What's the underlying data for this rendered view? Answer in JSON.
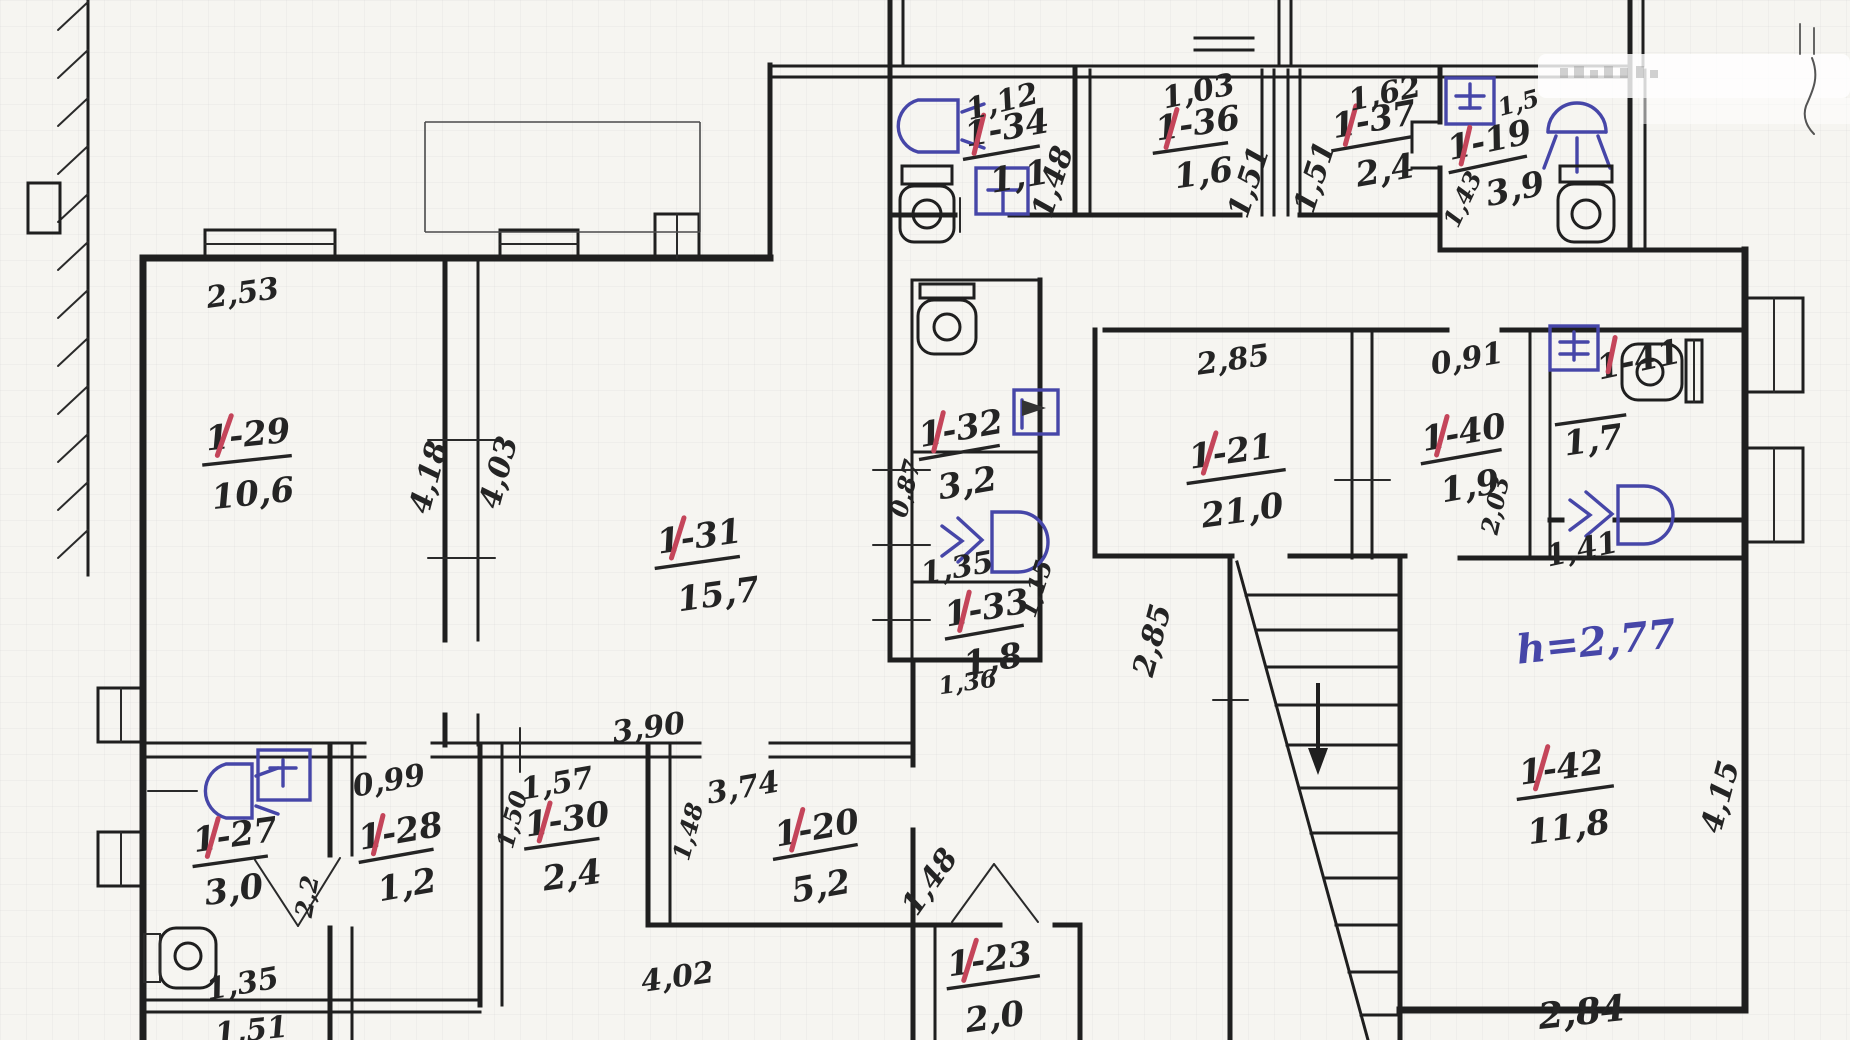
{
  "plan": {
    "type": "hand-drawn floor plan",
    "note_height": "h=2,77",
    "accent_red": "#c4455a",
    "accent_blue": "#4646a8",
    "wall_color": "#1f1f1f"
  },
  "rooms": [
    {
      "id": "1-34",
      "area": "1,1"
    },
    {
      "id": "1-36",
      "area": "1,6"
    },
    {
      "id": "1-37",
      "area": "2,4"
    },
    {
      "id": "1-19",
      "area": "3,9"
    },
    {
      "id": "1-29",
      "area": "10,6"
    },
    {
      "id": "1-31",
      "area": "15,7"
    },
    {
      "id": "1-32",
      "area": "3,2"
    },
    {
      "id": "1-33",
      "area": "1,8"
    },
    {
      "id": "1-21",
      "area": "21,0"
    },
    {
      "id": "1-40",
      "area": "1,9"
    },
    {
      "id": "1-41",
      "area": "1,7"
    },
    {
      "id": "1-42",
      "area": "11,8"
    },
    {
      "id": "1-27",
      "area": "3,0"
    },
    {
      "id": "1-28",
      "area": "1,2"
    },
    {
      "id": "1-30",
      "area": "2,4"
    },
    {
      "id": "1-20",
      "area": "5,2"
    },
    {
      "id": "1-23",
      "area": "2,0"
    }
  ],
  "dims": {
    "t29": "2,53",
    "w418": "4,18",
    "w403": "4,03",
    "b31": "3,90",
    "t34": "1,12",
    "r34": "1,48",
    "t36": "1,03",
    "r36": "1,51",
    "l37": "1,51",
    "t37": "1,62",
    "t19": "1,5",
    "l19": "1,43",
    "w087": "0,87",
    "nook": "1,35",
    "r33": "1,15",
    "b33": "1,36",
    "t21": "2,85",
    "hall": "2,85",
    "t40": "0,91",
    "r41": "2,03",
    "b41": "1,41",
    "r42": "4,15",
    "b42": "2,84",
    "t28": "0,99",
    "door28": "2,2",
    "wc27": "1,35",
    "b27": "1,51",
    "t30": "1,57",
    "l30": "1,50",
    "t20": "3,74",
    "l20": "1,48",
    "r20": "1,48",
    "b20": "4,02"
  }
}
